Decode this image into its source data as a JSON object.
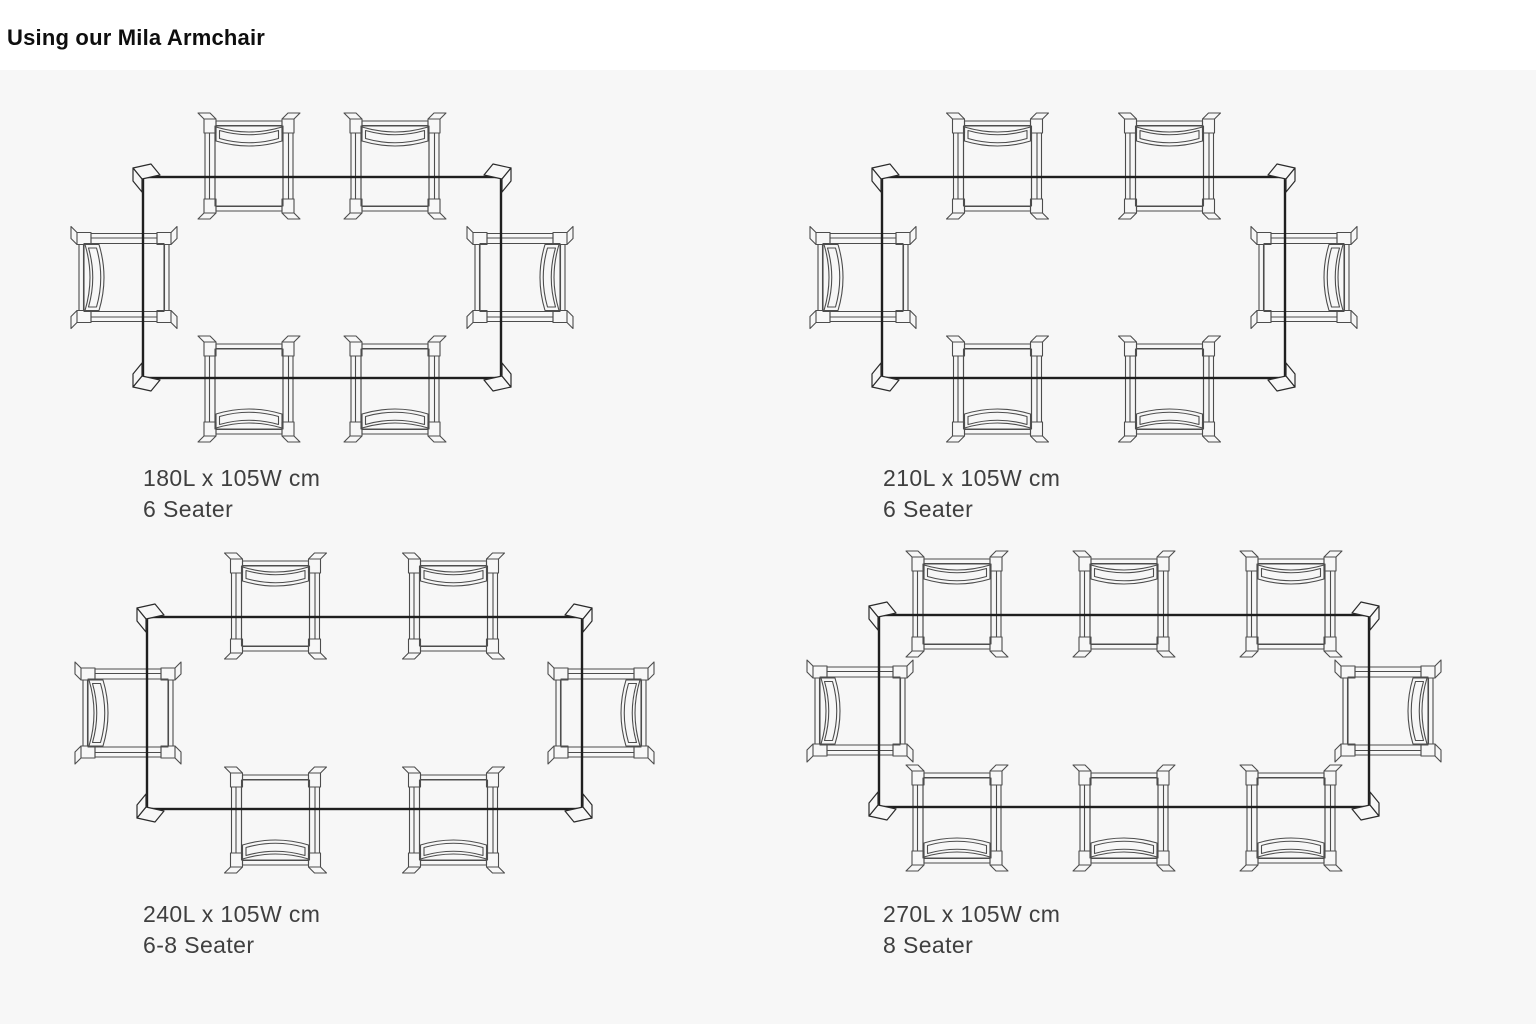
{
  "page": {
    "title": "Using our Mila Armchair"
  },
  "colors": {
    "page_background": "#ffffff",
    "panel_background": "#f7f7f7",
    "table_line": "#1f1f1f",
    "chair_line": "#4d4d4d",
    "corner_leg_line": "#2b2b2b",
    "caption_text": "#3f3f3f",
    "title_text": "#0e0e0e"
  },
  "diagrams": [
    {
      "dimensions": "180L x 105W cm",
      "seater": "6 Seater",
      "chairs": {
        "top": 2,
        "bottom": 2,
        "left": 1,
        "right": 1
      },
      "total_chairs": 6
    },
    {
      "dimensions": "210L x 105W cm",
      "seater": "6 Seater",
      "chairs": {
        "top": 2,
        "bottom": 2,
        "left": 1,
        "right": 1
      },
      "total_chairs": 6
    },
    {
      "dimensions": "240L x 105W cm",
      "seater": "6-8 Seater",
      "chairs": {
        "top": 2,
        "bottom": 2,
        "left": 1,
        "right": 1
      },
      "total_chairs": 6
    },
    {
      "dimensions": "270L x 105W cm",
      "seater": "8 Seater",
      "chairs": {
        "top": 3,
        "bottom": 3,
        "left": 1,
        "right": 1
      },
      "total_chairs": 8
    }
  ]
}
